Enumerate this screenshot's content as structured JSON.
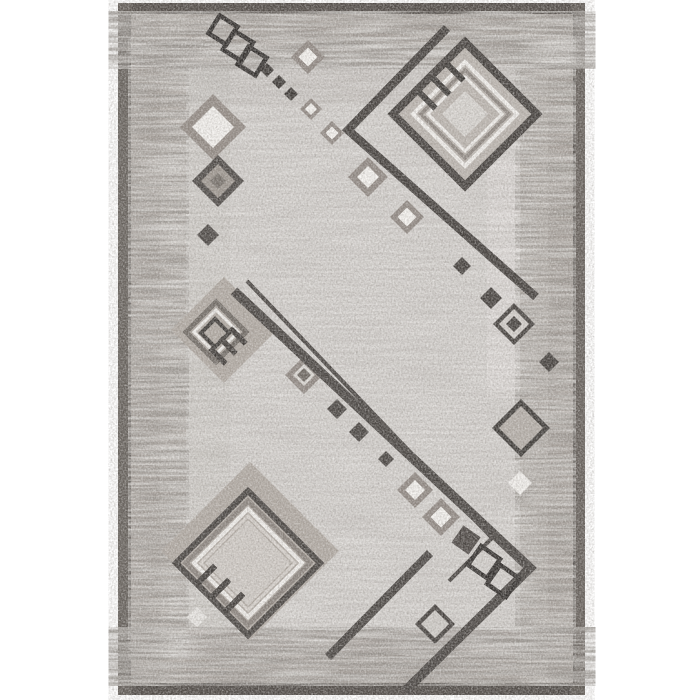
{
  "meta": {
    "kind": "product-photo",
    "subject": "gray geometric area rug, portrait orientation, centered on white background"
  },
  "palette": {
    "background": "#ffffff",
    "frame": "#5a5550",
    "frame_top": "#4c4742",
    "frame_side": "#6e6862",
    "border_base": "#a8a19b",
    "border_light": "#c6c1bc",
    "panel_base": "#d9d6d3",
    "taupe_fill": "#b1aaa3",
    "taupe_ring": "#8f8781",
    "white_detail": "#f5f3f0",
    "cream_detail": "#d9d4cf",
    "charcoal": "#46423f",
    "near_black": "#2e2b29",
    "gray_ring": "#8a837d"
  },
  "rug": {
    "x": 118,
    "y": 3,
    "w": 467,
    "h": 692,
    "frame_strips": [
      {
        "name": "frame-top",
        "x": 118,
        "y": 3,
        "w": 467,
        "h": 12,
        "fill": "#4c4742",
        "op": 0.85
      },
      {
        "name": "frame-bottom",
        "x": 118,
        "y": 683,
        "w": 467,
        "h": 12,
        "fill": "#4a4541",
        "op": 0.85
      },
      {
        "name": "frame-left",
        "x": 118,
        "y": 3,
        "w": 14,
        "h": 692,
        "fill": "#6e6862",
        "op": 0.55
      },
      {
        "name": "frame-right",
        "x": 571,
        "y": 3,
        "w": 14,
        "h": 692,
        "fill": "#6e6862",
        "op": 0.45
      }
    ],
    "border": {
      "x": 131,
      "y": 14,
      "w": 442,
      "h": 669,
      "color": "#a8a19b"
    },
    "panel": {
      "x": 186,
      "y": 66,
      "w": 334,
      "h": 564,
      "color": "#d9d6d3"
    },
    "inner_edge_line": {
      "x": 130,
      "y": 13,
      "w": 444,
      "h": 671,
      "color": "#433f3b",
      "sw": 2
    },
    "patches": [
      {
        "name": "left-border-light-column",
        "x": 160,
        "y": 14,
        "w": 26,
        "h": 669,
        "fill": "#c6c1bc",
        "op": 0.5
      },
      {
        "name": "top-border-light-row",
        "x": 131,
        "y": 44,
        "w": 442,
        "h": 22,
        "fill": "#c6c1bc",
        "op": 0.35
      },
      {
        "name": "right-border-light-column",
        "x": 520,
        "y": 14,
        "w": 28,
        "h": 669,
        "fill": "#cac5c0",
        "op": 0.5
      },
      {
        "name": "bottom-border-upper-strip",
        "x": 131,
        "y": 630,
        "w": 442,
        "h": 24,
        "fill": "#b7b1ab",
        "op": 0.55
      },
      {
        "name": "panel-top-shade",
        "x": 186,
        "y": 66,
        "w": 334,
        "h": 38,
        "fill": "#8d867f",
        "op": 0.14
      },
      {
        "name": "panel-right-light-column",
        "x": 487,
        "y": 158,
        "w": 33,
        "h": 240,
        "fill": "#e9e6e3",
        "op": 0.55
      },
      {
        "name": "panel-left-shade",
        "x": 186,
        "y": 66,
        "w": 44,
        "h": 564,
        "fill": "#8d867f",
        "op": 0.08
      }
    ],
    "streak_zones": [
      {
        "name": "top-border-texture",
        "x": 131,
        "y": 14,
        "w": 442,
        "h": 52,
        "dark": 0.85,
        "light": 0.6
      },
      {
        "name": "left-border-texture",
        "x": 131,
        "y": 66,
        "w": 55,
        "h": 564,
        "dark": 0.8,
        "light": 0.6
      },
      {
        "name": "right-border-texture",
        "x": 518,
        "y": 66,
        "w": 55,
        "h": 564,
        "dark": 0.75,
        "light": 0.55
      },
      {
        "name": "bottom-border-texture",
        "x": 131,
        "y": 630,
        "w": 442,
        "h": 53,
        "dark": 0.9,
        "light": 0.5
      },
      {
        "name": "panel-texture",
        "x": 186,
        "y": 66,
        "w": 334,
        "h": 564,
        "dark": 0.2,
        "light": 0.3
      }
    ]
  },
  "shapes": [
    {
      "name": "topright-bracket",
      "type": "poly",
      "points": [
        [
          447,
          28
        ],
        [
          348,
          130
        ],
        [
          536,
          297
        ]
      ],
      "sw": 8.5,
      "color": "#413d3a"
    },
    {
      "name": "topright-motif-field",
      "type": "diamond",
      "cx": 465,
      "cy": 114,
      "d": 67,
      "fill": "#bcb6b0"
    },
    {
      "name": "topright-motif-ring-outer",
      "type": "ring",
      "cx": 465,
      "cy": 114,
      "d": 72,
      "sw": 8,
      "color": "#413d3a"
    },
    {
      "name": "topright-motif-ring-white1",
      "type": "ring",
      "cx": 465,
      "cy": 114,
      "d": 52,
      "sw": 4,
      "color": "#f3f1ee"
    },
    {
      "name": "topright-motif-ring-gray",
      "type": "ring",
      "cx": 465,
      "cy": 114,
      "d": 44,
      "sw": 3.5,
      "color": "#8d8680"
    },
    {
      "name": "topright-motif-ring-white2",
      "type": "ring",
      "cx": 465,
      "cy": 114,
      "d": 37,
      "sw": 3,
      "color": "#f3f1ee"
    },
    {
      "name": "topright-motif-center",
      "type": "diamond",
      "cx": 465,
      "cy": 114,
      "d": 23,
      "fill": "#d9d6d2"
    },
    {
      "name": "topright-tassel-1",
      "type": "bar",
      "cx": 455,
      "cy": 72,
      "len": 24,
      "wid": 6,
      "rot": 45,
      "color": "#3a3734"
    },
    {
      "name": "topright-tassel-2",
      "type": "bar",
      "cx": 441,
      "cy": 86,
      "len": 24,
      "wid": 6,
      "rot": 45,
      "color": "#3a3734"
    },
    {
      "name": "topright-tassel-3",
      "type": "bar",
      "cx": 427,
      "cy": 100,
      "len": 24,
      "wid": 6,
      "rot": 45,
      "color": "#3a3734"
    },
    {
      "name": "topleft-chain-square-1",
      "type": "tsquare",
      "cx": 223,
      "cy": 30,
      "side": 21,
      "rot": 32,
      "sw": 4.5,
      "color": "#2e2b29"
    },
    {
      "name": "topleft-chain-square-2",
      "type": "tsquare",
      "cx": 238,
      "cy": 46,
      "side": 22,
      "rot": 32,
      "sw": 4.5,
      "color": "#2e2b29"
    },
    {
      "name": "topleft-chain-square-3",
      "type": "tsquare",
      "cx": 252,
      "cy": 61,
      "side": 21,
      "rot": 32,
      "sw": 4.5,
      "color": "#2e2b29"
    },
    {
      "name": "topleft-chain-dot-1",
      "type": "diamond",
      "cx": 267,
      "cy": 70,
      "d": 7,
      "fill": "#3a3633"
    },
    {
      "name": "topleft-chain-dot-2",
      "type": "diamond",
      "cx": 279,
      "cy": 82,
      "d": 7,
      "fill": "#3a3633"
    },
    {
      "name": "topleft-chain-dot-3",
      "type": "diamond",
      "cx": 291,
      "cy": 94,
      "d": 7,
      "fill": "#3a3633"
    },
    {
      "name": "chain-taupe-diamond-1",
      "type": "target",
      "cx": 308,
      "cy": 57,
      "rings": [
        [
          17,
          "#8f8781"
        ],
        [
          9.5,
          "#f7f5f2"
        ]
      ]
    },
    {
      "name": "chain-taupe-diamond-2",
      "type": "target",
      "cx": 311,
      "cy": 109,
      "rings": [
        [
          11,
          "#8f8781"
        ],
        [
          6,
          "#f7f5f2"
        ]
      ]
    },
    {
      "name": "chain-taupe-diamond-3",
      "type": "target",
      "cx": 332,
      "cy": 133,
      "rings": [
        [
          12,
          "#8f8781"
        ],
        [
          6.5,
          "#f7f5f2"
        ]
      ]
    },
    {
      "name": "chain-taupe-diamond-4",
      "type": "target",
      "cx": 368,
      "cy": 177,
      "rings": [
        [
          20,
          "#8f8781"
        ],
        [
          11,
          "#f7f5f2"
        ]
      ]
    },
    {
      "name": "chain-taupe-diamond-5",
      "type": "target",
      "cx": 407,
      "cy": 217,
      "rings": [
        [
          17,
          "#8f8781"
        ],
        [
          9.5,
          "#f7f5f2"
        ]
      ]
    },
    {
      "name": "left-diamond-large",
      "type": "target",
      "cx": 213,
      "cy": 127,
      "rings": [
        [
          33,
          "#928a84"
        ],
        [
          21,
          "#f5f3f0"
        ]
      ]
    },
    {
      "name": "left-diamond-dark",
      "type": "target",
      "cx": 218,
      "cy": 181,
      "rings": [
        [
          26,
          "#4a4643"
        ],
        [
          17,
          "#9d968f"
        ],
        [
          8,
          "#756f69"
        ]
      ]
    },
    {
      "name": "left-dot",
      "type": "diamond",
      "cx": 208,
      "cy": 235,
      "d": 11,
      "fill": "#4a4643"
    },
    {
      "name": "midleft-motif-base",
      "type": "diamond",
      "cx": 224,
      "cy": 330,
      "d": 53,
      "fill": "#b1aaa3"
    },
    {
      "name": "midleft-motif-ring-gray",
      "type": "ring",
      "cx": 216,
      "cy": 332,
      "d": 30,
      "sw": 5,
      "color": "#6f6963"
    },
    {
      "name": "midleft-motif-ring-white",
      "type": "ring",
      "cx": 216,
      "cy": 332,
      "d": 22,
      "sw": 3,
      "color": "#f2f0ed"
    },
    {
      "name": "midleft-motif-ring-dark",
      "type": "ring",
      "cx": 215,
      "cy": 333,
      "d": 14,
      "sw": 4,
      "color": "#3c3936"
    },
    {
      "name": "midleft-tassel-1",
      "type": "bar",
      "cx": 238,
      "cy": 336,
      "len": 22,
      "wid": 5.5,
      "rot": 45,
      "color": "#3e3a37"
    },
    {
      "name": "midleft-tassel-2",
      "type": "bar",
      "cx": 228,
      "cy": 346,
      "len": 22,
      "wid": 5.5,
      "rot": 45,
      "color": "#3e3a37"
    },
    {
      "name": "midleft-tassel-3",
      "type": "bar",
      "cx": 218,
      "cy": 356,
      "len": 22,
      "wid": 5.5,
      "rot": 45,
      "color": "#3e3a37"
    },
    {
      "name": "mid-chain-taupe-dark",
      "type": "target",
      "cx": 304,
      "cy": 375,
      "rings": [
        [
          19,
          "#8f8781"
        ],
        [
          11,
          "#dedbd7"
        ],
        [
          7,
          "#6b655f"
        ]
      ]
    },
    {
      "name": "mid-chain-dot-1",
      "type": "diamond",
      "cx": 337,
      "cy": 409,
      "d": 10,
      "fill": "#46423f"
    },
    {
      "name": "mid-chain-dot-2",
      "type": "diamond",
      "cx": 359,
      "cy": 432,
      "d": 10,
      "fill": "#46423f"
    },
    {
      "name": "mid-chain-dot-3",
      "type": "diamond",
      "cx": 386,
      "cy": 459,
      "d": 8,
      "fill": "#46423f"
    },
    {
      "name": "bottomleft-motif-base",
      "type": "diamond",
      "cx": 250,
      "cy": 551,
      "d": 89,
      "fill": "#b1aaa3"
    },
    {
      "name": "bottomleft-motif-ring-dark",
      "type": "ring",
      "cx": 248,
      "cy": 563,
      "d": 72,
      "sw": 6,
      "color": "#45413e"
    },
    {
      "name": "bottomleft-motif-ring-gray",
      "type": "ring",
      "cx": 248,
      "cy": 563,
      "d": 62,
      "sw": 5,
      "color": "#8a837d"
    },
    {
      "name": "bottomleft-motif-ring-white",
      "type": "ring",
      "cx": 248,
      "cy": 563,
      "d": 54,
      "sw": 4,
      "color": "#f2f0ed"
    },
    {
      "name": "bottomleft-motif-ring-cream",
      "type": "ring",
      "cx": 248,
      "cy": 563,
      "d": 47,
      "sw": 3,
      "color": "#d9d4cf"
    },
    {
      "name": "bottomleft-motif-center",
      "type": "diamond",
      "cx": 248,
      "cy": 563,
      "d": 43,
      "fill": "#d0cbc6"
    },
    {
      "name": "bottomleft-tassel-1",
      "type": "bar",
      "cx": 206,
      "cy": 575,
      "len": 26,
      "wid": 6,
      "rot": -45,
      "color": "#3e3a37"
    },
    {
      "name": "bottomleft-tassel-2",
      "type": "bar",
      "cx": 220,
      "cy": 589,
      "len": 26,
      "wid": 6,
      "rot": -45,
      "color": "#3e3a37"
    },
    {
      "name": "bottomleft-tassel-3",
      "type": "bar",
      "cx": 234,
      "cy": 603,
      "len": 26,
      "wid": 6,
      "rot": -45,
      "color": "#3e3a37"
    },
    {
      "name": "border-white-spot",
      "type": "diamond",
      "cx": 197,
      "cy": 617,
      "d": 10,
      "fill": "#e9e7e4"
    },
    {
      "name": "thin-line",
      "type": "poly",
      "points": [
        [
          247,
          281
        ],
        [
          492,
          538
        ],
        [
          449,
          581
        ]
      ],
      "sw": 4,
      "color": "#46423f"
    },
    {
      "name": "main-band",
      "type": "poly",
      "points": [
        [
          234,
          291
        ],
        [
          530,
          568
        ],
        [
          405,
          691
        ]
      ],
      "sw": 9.5,
      "color": "#46423f"
    },
    {
      "name": "lower-band",
      "type": "poly",
      "points": [
        [
          430,
          553
        ],
        [
          328,
          657
        ]
      ],
      "sw": 8.5,
      "color": "#46423f"
    },
    {
      "name": "br-chain-taupe-1",
      "type": "target",
      "cx": 415,
      "cy": 490,
      "rings": [
        [
          18,
          "#8f8781"
        ],
        [
          10,
          "#f5f3f0"
        ]
      ]
    },
    {
      "name": "br-chain-taupe-2",
      "type": "target",
      "cx": 441,
      "cy": 517,
      "rings": [
        [
          19,
          "#8f8781"
        ],
        [
          10.5,
          "#f5f3f0"
        ]
      ]
    },
    {
      "name": "br-chain-solid-square",
      "type": "tsquare",
      "cx": 466,
      "cy": 540,
      "side": 21,
      "rot": 35,
      "fill": "#4a4542"
    },
    {
      "name": "br-chain-square-1",
      "type": "tsquare",
      "cx": 484,
      "cy": 562,
      "side": 23,
      "rot": 35,
      "sw": 4.5,
      "color": "#2e2b29"
    },
    {
      "name": "br-chain-square-2",
      "type": "tsquare",
      "cx": 503,
      "cy": 581,
      "side": 23,
      "rot": 35,
      "sw": 4.5,
      "color": "#2e2b29"
    },
    {
      "name": "bottom-dark-diamond",
      "type": "target",
      "cx": 435,
      "cy": 624,
      "rings": [
        [
          20,
          "#413d3a"
        ],
        [
          14,
          "#cfccc8"
        ]
      ]
    },
    {
      "name": "right-chain-dot-1",
      "type": "diamond",
      "cx": 462,
      "cy": 266,
      "d": 9,
      "fill": "#413d3a"
    },
    {
      "name": "right-chain-dot-2",
      "type": "diamond",
      "cx": 491,
      "cy": 298,
      "d": 11,
      "fill": "#413d3a"
    },
    {
      "name": "right-chain-ringed",
      "type": "target",
      "cx": 514,
      "cy": 324,
      "rings": [
        [
          21,
          "#413d3a"
        ],
        [
          15,
          "#d5d1cd"
        ],
        [
          8,
          "#413d3a"
        ]
      ]
    },
    {
      "name": "right-chain-dot-3",
      "type": "diamond",
      "cx": 549,
      "cy": 362,
      "d": 10,
      "fill": "#413d3a"
    },
    {
      "name": "right-hollow-diamond",
      "type": "target",
      "cx": 521,
      "cy": 428,
      "rings": [
        [
          29,
          "#3b3835"
        ],
        [
          22,
          "#b5afa9"
        ]
      ]
    },
    {
      "name": "right-white-diamond",
      "type": "diamond",
      "cx": 520,
      "cy": 483,
      "d": 12,
      "fill": "#f4f2ef"
    }
  ]
}
